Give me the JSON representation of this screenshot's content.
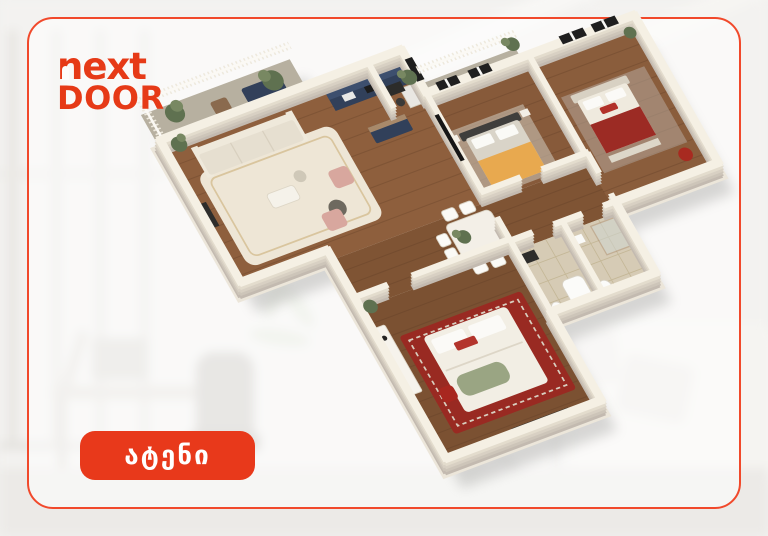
{
  "brand": {
    "name": "NEXT DOOR",
    "logo_line1": "next",
    "logo_line2": "DOOR",
    "logo_color": "#e63a17"
  },
  "location_badge": {
    "label": "ატენი",
    "background": "#e8391b",
    "text_color": "#ffffff"
  },
  "card": {
    "border_color": "#f1492b",
    "background": "rgba(255,255,255,0.55)"
  },
  "floor_plan": {
    "type": "3d-isometric-apartment-render",
    "colors": {
      "wall_top": "#f5f0e4",
      "wall_side": "#c3bab0",
      "floor_wood": "#8e5f3d",
      "floor_wood_dark": "#7b5132",
      "bathroom_tile": "#d6cbb5",
      "rug_cream": "#eee6d6",
      "rug_red": "#992a22",
      "bed_orange": "#e8a94f",
      "accent_red": "#a82a20",
      "kitchen_navy": "#31405a",
      "plant_green": "#5f7150",
      "window_dark": "#1f1f1f"
    }
  }
}
